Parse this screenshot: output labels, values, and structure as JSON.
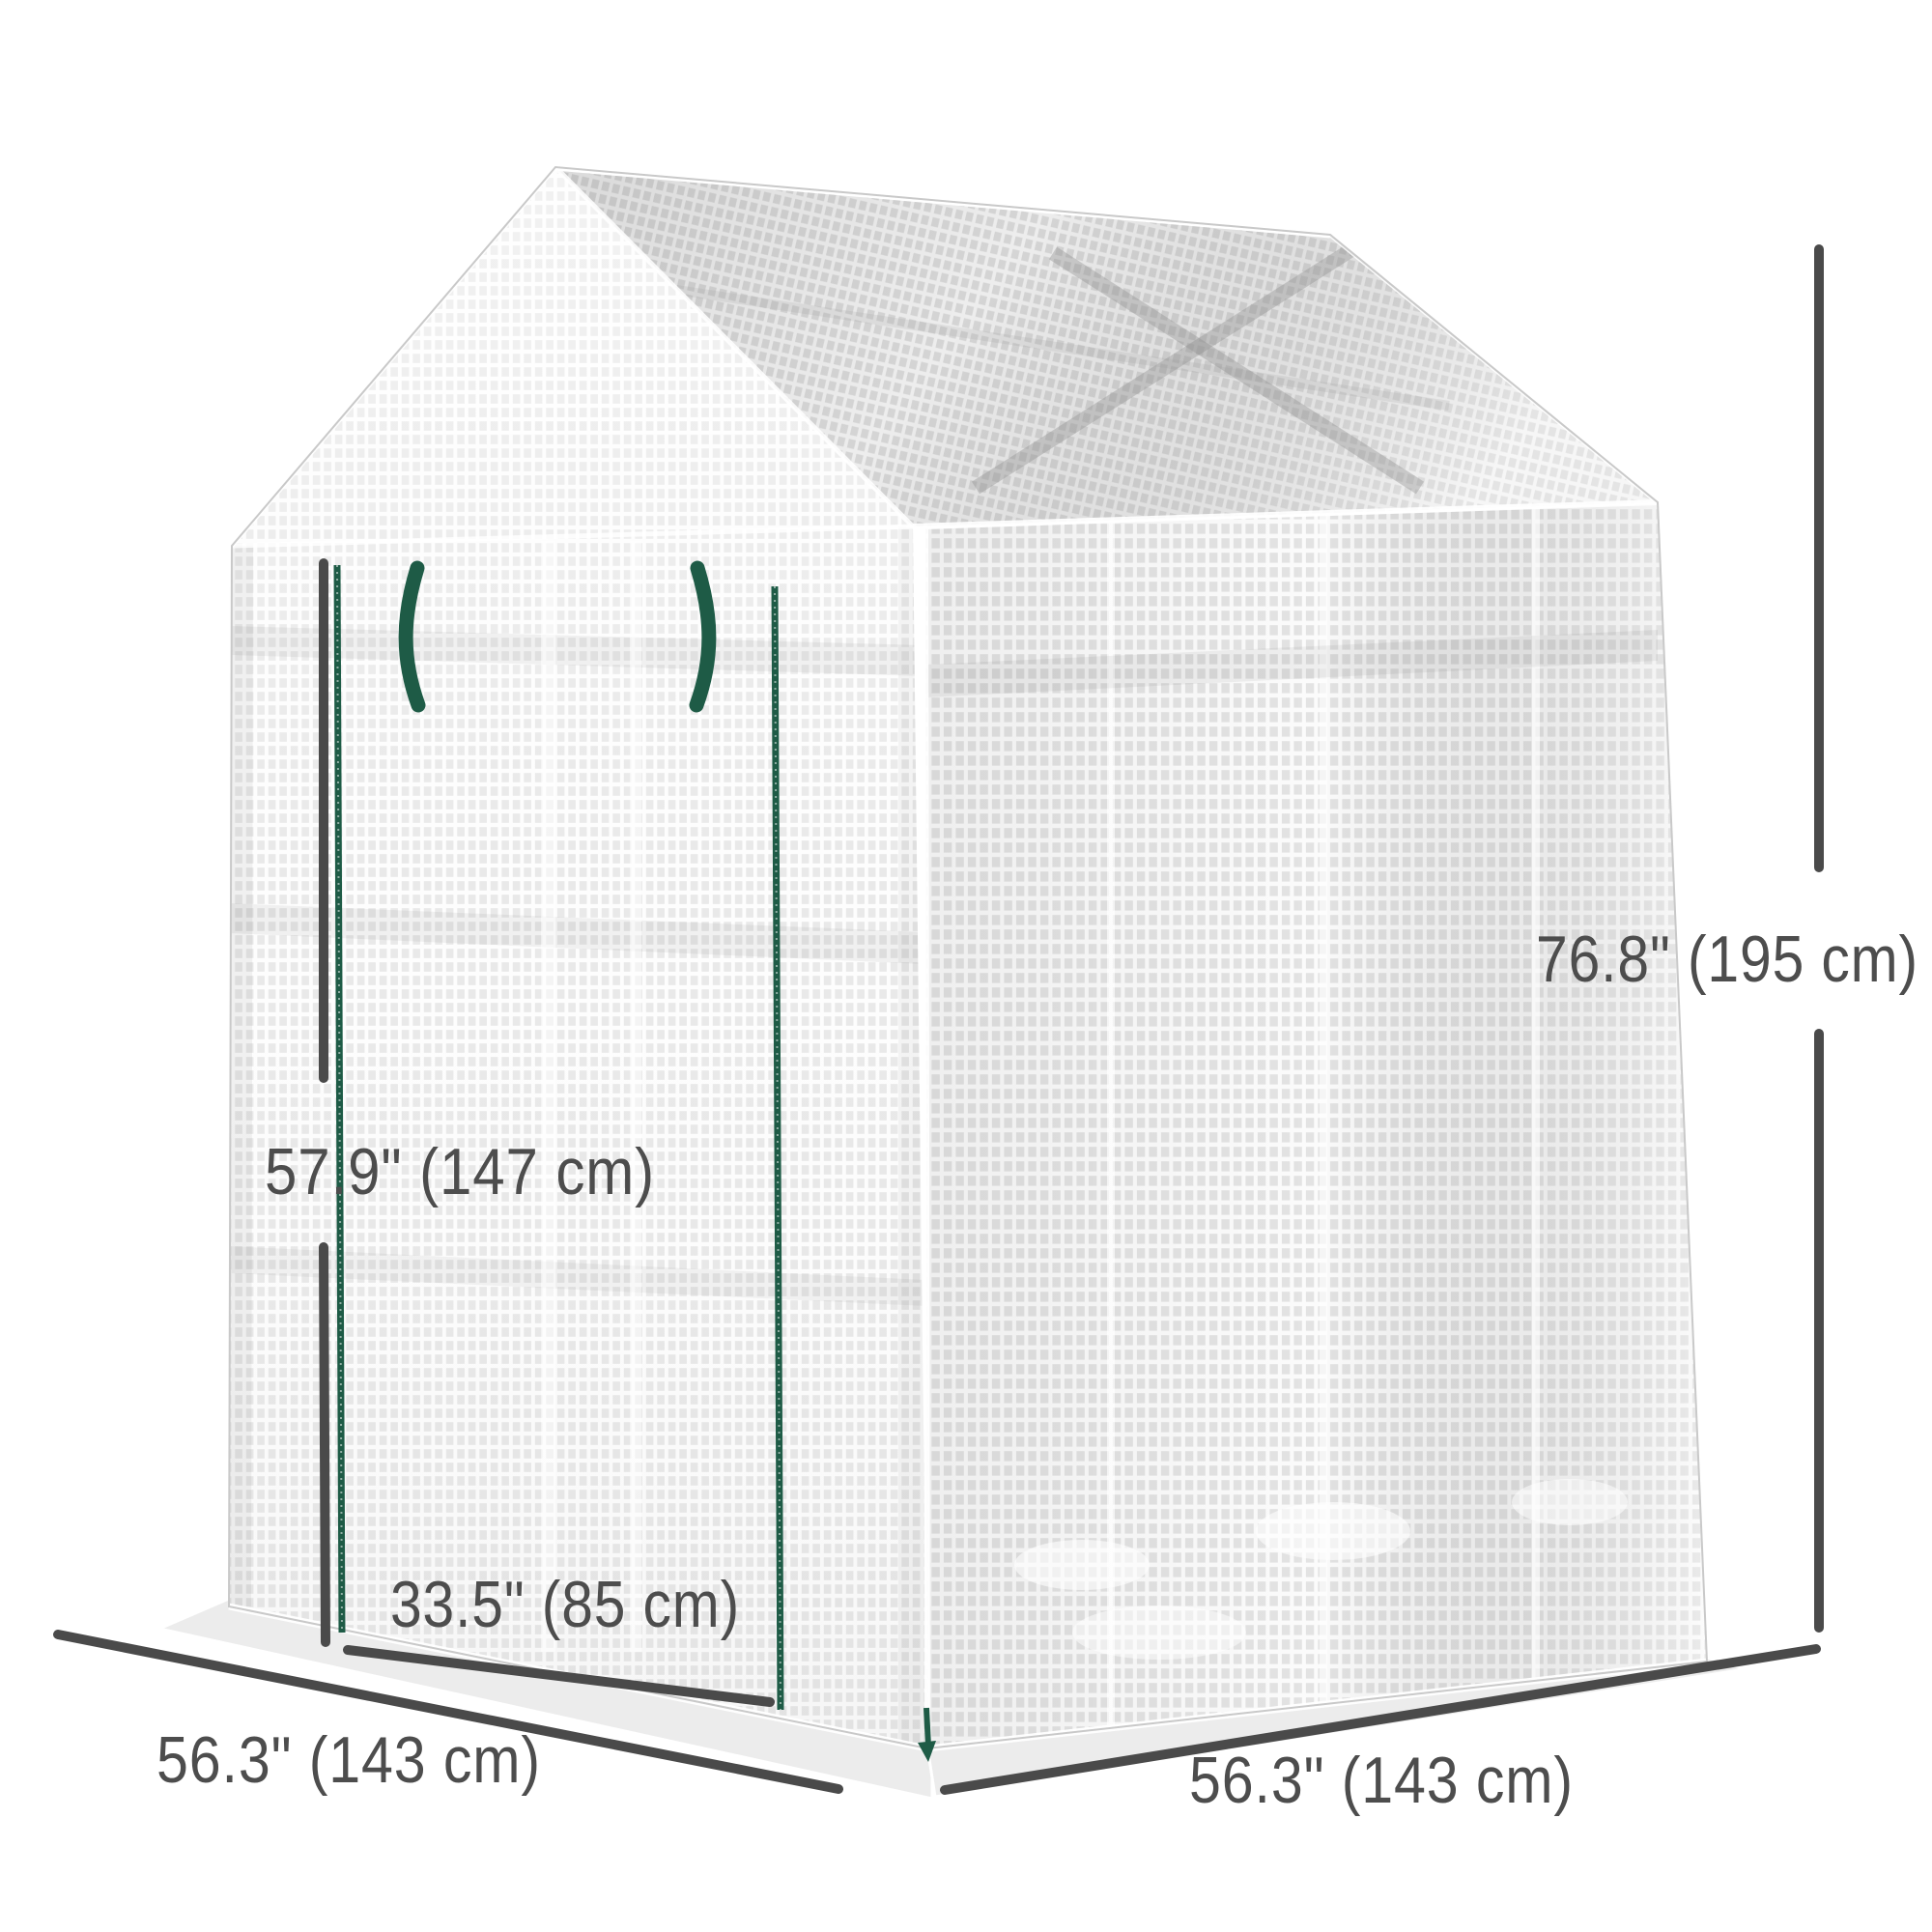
{
  "figure": {
    "kind": "product dimension diagram",
    "subject": "walk-in greenhouse with white mesh cover, peaked roof and double-zipper door"
  },
  "dimension_labels": {
    "total_height": "76.8\" (195 cm)",
    "door_height": "57.9\" (147 cm)",
    "door_width": "33.5\" (85 cm)",
    "base_depth": "56.3\" (143 cm)",
    "base_width": "56.3\" (143 cm)"
  },
  "colors": {
    "background": "#ffffff",
    "dimension_line": "#4a4a4a",
    "label_text": "#4d4d4d",
    "accent_green": "#1e5b46",
    "mesh_thread": "#ffffff",
    "front_cell": "#e9e9e9",
    "roof_cell": "#d9d9d9",
    "side_cell": "#e3e3e3"
  }
}
